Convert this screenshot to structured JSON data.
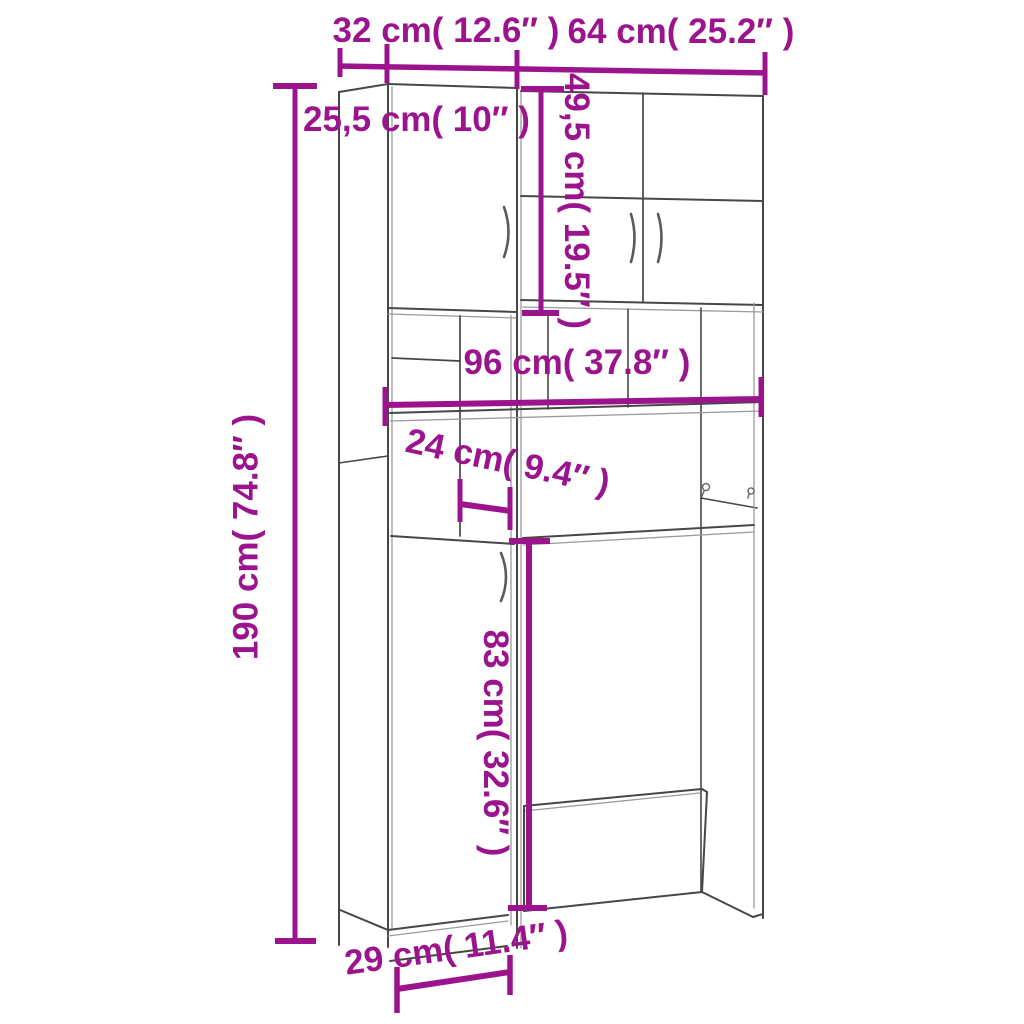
{
  "diagram": {
    "background_color": "#ffffff",
    "accent_color": "#9B148D",
    "line_color": "#474747",
    "light_line_color": "#9a9a9a",
    "labels": {
      "width_left": "32 cm( 12.6″ )",
      "width_right": "64 cm( 25.2″ )",
      "depth_top": "25,5 cm( 10″ )",
      "height_upper_cabinet": "49,5 cm( 19.5″ )",
      "width_middle_shelf": "96 cm( 37.8″ )",
      "depth_middle_shelf": "24 cm( 9.4″ )",
      "height_total": "190 cm( 74.8″ )",
      "height_washer_space": "83 cm( 32.6″ )",
      "depth_base": "29 cm( 11.4″ )"
    }
  }
}
